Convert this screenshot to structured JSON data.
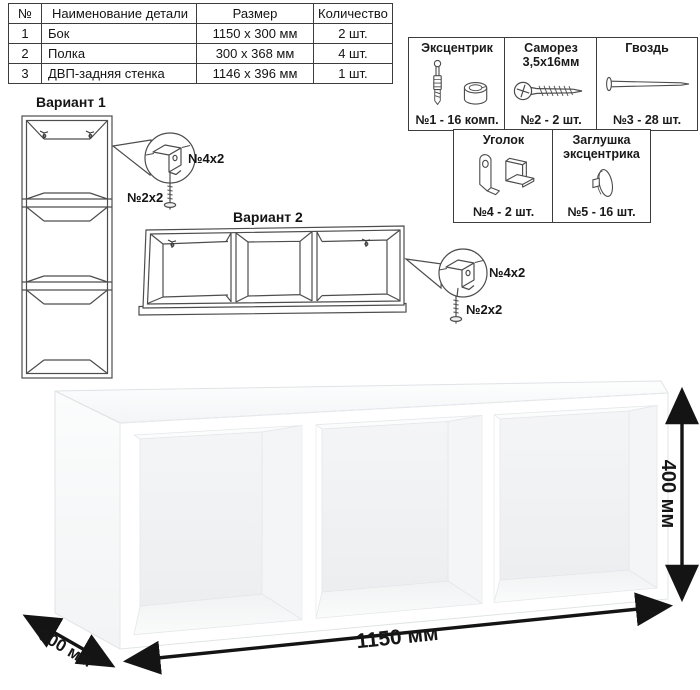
{
  "parts_table": {
    "headers": {
      "num": "№",
      "name": "Наименование детали",
      "size": "Размер",
      "qty": "Количество"
    },
    "rows": [
      {
        "num": "1",
        "name": "Бок",
        "size": "1150 x 300 мм",
        "qty": "2 шт."
      },
      {
        "num": "2",
        "name": "Полка",
        "size": "300 x 368 мм",
        "qty": "4 шт."
      },
      {
        "num": "3",
        "name": "ДВП-задняя стенка",
        "size": "1146 x 396 мм",
        "qty": "1 шт."
      }
    ]
  },
  "hardware": {
    "items": [
      {
        "title": "Эксцентрик",
        "subtitle": "",
        "count": "№1 - 16 комп.",
        "icon": "cam-and-dowel-icon"
      },
      {
        "title": "Саморез",
        "subtitle": "3,5x16мм",
        "count": "№2 - 2 шт.",
        "icon": "screw-icon"
      },
      {
        "title": "Гвоздь",
        "subtitle": "",
        "count": "№3 - 28 шт.",
        "icon": "nail-icon"
      },
      {
        "title": "Уголок",
        "subtitle": "",
        "count": "№4 - 2 шт.",
        "icon": "corner-bracket-icon"
      },
      {
        "title": "Заглушка",
        "subtitle": "эксцентрика",
        "count": "№5 - 16 шт.",
        "icon": "cam-cap-icon"
      }
    ]
  },
  "variants": [
    {
      "label": "Вариант 1",
      "callout": {
        "bracket_label": "№4x2",
        "screw_label": "№2x2"
      }
    },
    {
      "label": "Вариант 2",
      "callout": {
        "bracket_label": "№4x2",
        "screw_label": "№2x2"
      }
    }
  ],
  "dimensions": {
    "width": "1150 мм",
    "depth": "300 мм",
    "height": "400 мм"
  },
  "colors": {
    "line": "#4d4d4d",
    "dimension": "#141414",
    "shelf_shade": "#f0f1f3"
  }
}
